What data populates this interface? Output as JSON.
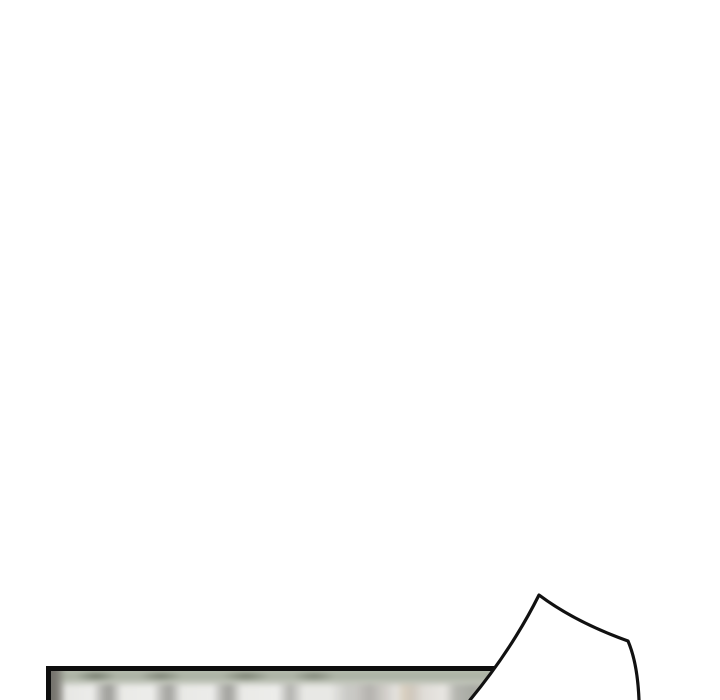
{
  "page": {
    "background_color": "#ffffff",
    "description": "blank white webtoon page area above a partially visible bottom panel"
  },
  "panel": {
    "border_color": "#0e0e0e",
    "border_thickness_px": 5,
    "left": 46,
    "top": 666,
    "right_hidden_behind_shape": true,
    "artwork": {
      "style": "blurred photographic background",
      "base_color": "#d3d2ce",
      "band_color": "#a9b0a2",
      "blob_light_color": "#ececea",
      "blob_gap_color": "#a5a5a1",
      "warm_stripe_color": "#d9cfc0",
      "dark_edge_color": "#6f6e68"
    }
  },
  "shape": {
    "name": "white-peak-shape",
    "fill_color": "#ffffff",
    "stroke_color": "#111111",
    "stroke_width": 3.2,
    "apex": [
      539,
      595
    ],
    "fill_path": "M539,595 Q575,622 628,641 C634,655 638,675 639,700 L470,700 C503,660 524,625 539,595 Z",
    "outline_path": "M470,700 C503,660 524,625 539,595 Q575,622 628,641 C634,655 638,675 639,700"
  }
}
